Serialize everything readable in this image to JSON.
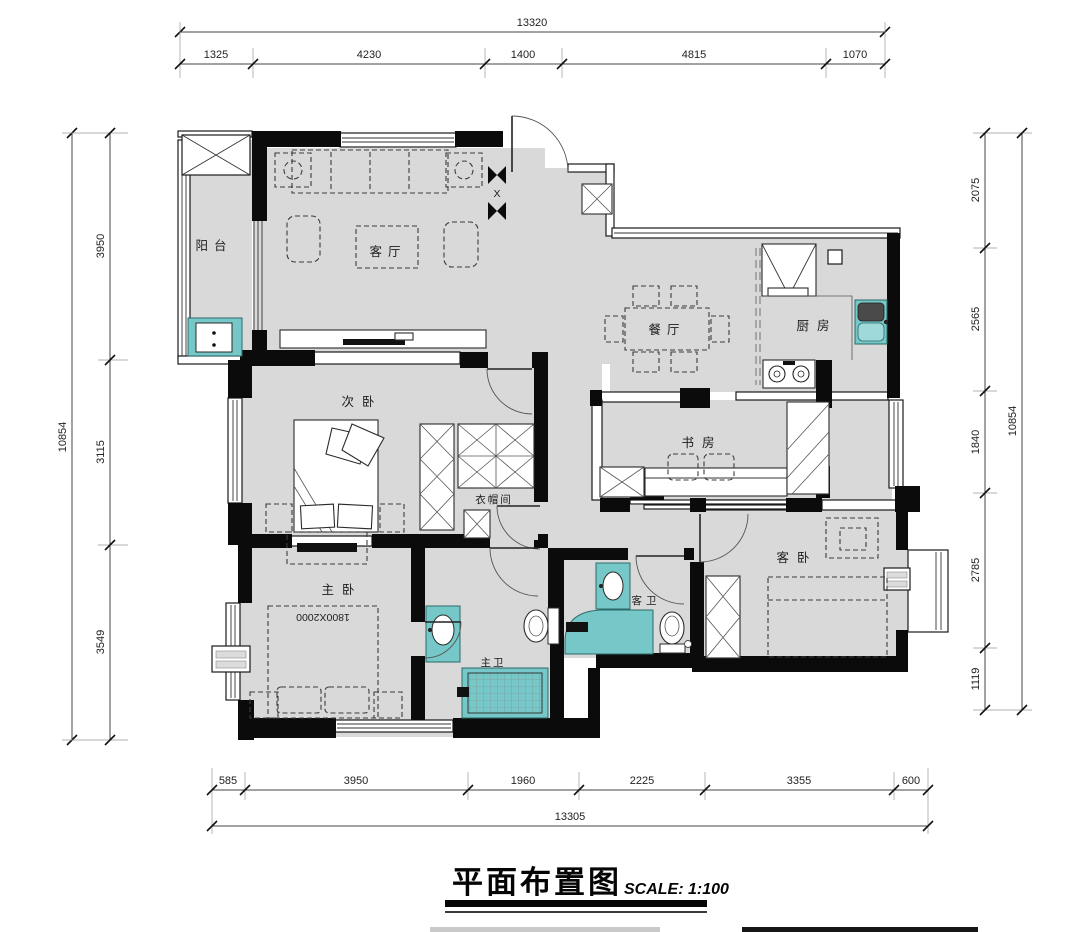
{
  "title_block": {
    "title": "平面布置图",
    "scale": "SCALE: 1:100"
  },
  "rooms": {
    "balcony": "阳台",
    "living_room": "客厅",
    "dining_room": "餐厅",
    "kitchen": "厨房",
    "second_bedroom": "次卧",
    "study": "书房",
    "cloakroom": "衣帽间",
    "master_bedroom": "主卧",
    "master_bathroom": "主卫",
    "guest_bathroom": "客卫",
    "guest_bedroom": "客卧"
  },
  "annotations": {
    "master_bed_size": "1800X2000",
    "entry_column_marker": "X"
  },
  "dimensions": {
    "top": {
      "total": "13320",
      "segments": [
        "1325",
        "4230",
        "1400",
        "4815",
        "1070"
      ]
    },
    "bottom": {
      "total": "13305",
      "segments": [
        "585",
        "3950",
        "1960",
        "2225",
        "3355",
        "600"
      ]
    },
    "left": {
      "total": "10854",
      "segments": [
        "3950",
        "3115",
        "3549"
      ]
    },
    "right": {
      "total": "10854",
      "segments": [
        "2075",
        "2565",
        "1840",
        "2785",
        "1119"
      ]
    }
  },
  "colors": {
    "floor": "#d9d9d9",
    "wall": "#0b0b0b",
    "fixture_teal": "#76c7c7",
    "line": "#333333"
  }
}
